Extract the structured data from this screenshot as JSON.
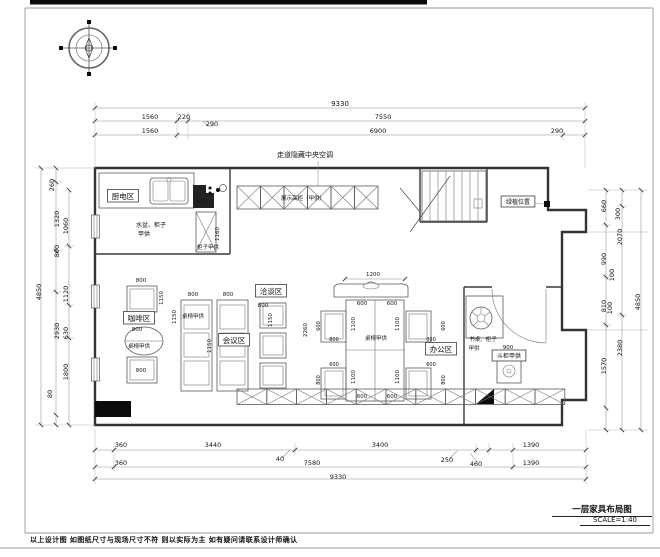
{
  "page": {
    "footer_note": "以上设计图 如图纸尺寸与现场尺寸不符 则以实际为主 如有疑问请联系设计师确认",
    "title_block": {
      "title": "一层家具布局图",
      "scale": "SCALE=1:40"
    }
  },
  "plan": {
    "annotations": [
      {
        "n": "dim-top-total",
        "t": "9330",
        "x": 340,
        "y": 106,
        "s": 7
      },
      {
        "n": "dim-top",
        "t": "1560",
        "x": 150,
        "y": 119
      },
      {
        "n": "dim-top",
        "t": "220",
        "x": 184,
        "y": 119
      },
      {
        "n": "dim-top",
        "t": "290",
        "x": 212,
        "y": 126
      },
      {
        "n": "dim-top",
        "t": "7550",
        "x": 383,
        "y": 119
      },
      {
        "n": "dim-top",
        "t": "1560",
        "x": 150,
        "y": 133
      },
      {
        "n": "dim-top",
        "t": "6900",
        "x": 378,
        "y": 133
      },
      {
        "n": "dim-top",
        "t": "290",
        "x": 557,
        "y": 133
      },
      {
        "n": "label-central-ac",
        "t": "走道隐藏中央空调",
        "x": 305,
        "y": 157,
        "s": 7
      },
      {
        "n": "dim-bottom",
        "t": "360",
        "x": 121,
        "y": 447
      },
      {
        "n": "dim-bottom",
        "t": "3440",
        "x": 213,
        "y": 447
      },
      {
        "n": "dim-bottom",
        "t": "40",
        "x": 280,
        "y": 461
      },
      {
        "n": "dim-bottom",
        "t": "3400",
        "x": 380,
        "y": 447
      },
      {
        "n": "dim-bottom",
        "t": "250",
        "x": 447,
        "y": 462
      },
      {
        "n": "dim-bottom",
        "t": "460",
        "x": 476,
        "y": 466
      },
      {
        "n": "dim-bottom",
        "t": "1390",
        "x": 531,
        "y": 447
      },
      {
        "n": "dim-bottom",
        "t": "360",
        "x": 121,
        "y": 465
      },
      {
        "n": "dim-bottom",
        "t": "7580",
        "x": 312,
        "y": 465
      },
      {
        "n": "dim-bottom",
        "t": "1390",
        "x": 531,
        "y": 465
      },
      {
        "n": "dim-bottom-total",
        "t": "9330",
        "x": 338,
        "y": 479
      },
      {
        "n": "dim-left-total",
        "t": "4850",
        "x": 41,
        "y": 292,
        "r": -90
      },
      {
        "n": "dim-left",
        "t": "260",
        "x": 54,
        "y": 185,
        "r": -90
      },
      {
        "n": "dim-left",
        "t": "1320",
        "x": 59,
        "y": 219,
        "r": -90
      },
      {
        "n": "dim-left",
        "t": "800",
        "x": 59,
        "y": 251,
        "r": -90
      },
      {
        "n": "dim-left",
        "t": "2930",
        "x": 59,
        "y": 331,
        "r": -90
      },
      {
        "n": "dim-left",
        "t": "80",
        "x": 52,
        "y": 394,
        "r": -90
      },
      {
        "n": "dim-left",
        "t": "1060",
        "x": 68,
        "y": 226,
        "r": -90
      },
      {
        "n": "dim-left",
        "t": "1120",
        "x": 68,
        "y": 294,
        "r": -90
      },
      {
        "n": "dim-left",
        "t": "630",
        "x": 68,
        "y": 333,
        "r": -90
      },
      {
        "n": "dim-left",
        "t": "1800",
        "x": 68,
        "y": 372,
        "r": -90
      },
      {
        "n": "dim-right-total",
        "t": "4850",
        "x": 640,
        "y": 302,
        "r": -90
      },
      {
        "n": "dim-right",
        "t": "300",
        "x": 620,
        "y": 214,
        "r": -90
      },
      {
        "n": "dim-right",
        "t": "2070",
        "x": 622,
        "y": 237,
        "r": -90
      },
      {
        "n": "dim-right",
        "t": "2380",
        "x": 622,
        "y": 348,
        "r": -90
      },
      {
        "n": "dim-right",
        "t": "660",
        "x": 606,
        "y": 206,
        "r": -90
      },
      {
        "n": "dim-right",
        "t": "990",
        "x": 606,
        "y": 259,
        "r": -90
      },
      {
        "n": "dim-right",
        "t": "100",
        "x": 614,
        "y": 275,
        "r": -90
      },
      {
        "n": "dim-right",
        "t": "810",
        "x": 606,
        "y": 306,
        "r": -90
      },
      {
        "n": "dim-right",
        "t": "100",
        "x": 612,
        "y": 308,
        "r": -90
      },
      {
        "n": "dim-right",
        "t": "1570",
        "x": 606,
        "y": 366,
        "r": -90
      },
      {
        "n": "zone-label-kitchen",
        "t": "厨电区",
        "x": 123,
        "y": 199,
        "b": 1,
        "s": 7.5
      },
      {
        "n": "zone-label-coffee",
        "t": "咖啡区",
        "x": 139,
        "y": 321,
        "b": 1,
        "s": 7.5
      },
      {
        "n": "zone-label-negotiation",
        "t": "洽谈区",
        "x": 271,
        "y": 294,
        "b": 1,
        "s": 7.5
      },
      {
        "n": "zone-label-meeting",
        "t": "会议区",
        "x": 234,
        "y": 343,
        "b": 1,
        "s": 7.5
      },
      {
        "n": "zone-label-office",
        "t": "办公区",
        "x": 441,
        "y": 352,
        "b": 1,
        "s": 7.5
      },
      {
        "n": "zone-label-chest",
        "t": "斗柜甲供",
        "x": 509,
        "y": 358,
        "b": 1,
        "s": 6
      },
      {
        "n": "zone-label-plant",
        "t": "绿植位置",
        "x": 518,
        "y": 204,
        "b": 1,
        "s": 6
      },
      {
        "n": "note-sink",
        "t": "水盆、柜子",
        "x": 151,
        "y": 227,
        "s": 6
      },
      {
        "n": "note-sink2",
        "t": "甲供",
        "x": 144,
        "y": 236,
        "s": 6
      },
      {
        "n": "dim-kitchen",
        "t": "600",
        "x": 202,
        "y": 203,
        "s": 5.5
      },
      {
        "n": "dim-kitchen",
        "t": "1160",
        "x": 219,
        "y": 234,
        "r": -90,
        "s": 5.5
      },
      {
        "n": "note-cabinet",
        "t": "柜子甲供",
        "x": 208,
        "y": 249,
        "s": 5.5
      },
      {
        "n": "note-display-cabinet",
        "t": "展示高柜（甲供）",
        "x": 303,
        "y": 200,
        "s": 5.5
      },
      {
        "n": "note-coffee-furniture",
        "t": "桌椅甲供",
        "x": 139,
        "y": 348,
        "s": 5.5
      },
      {
        "n": "note-meeting-furniture",
        "t": "桌椅甲供",
        "x": 193,
        "y": 318,
        "s": 5.5
      },
      {
        "n": "note-dining-furniture",
        "t": "桌椅甲供",
        "x": 376,
        "y": 340,
        "s": 5.5
      },
      {
        "n": "note-desk",
        "t": "书桌、柜子",
        "x": 483,
        "y": 341,
        "s": 5.5
      },
      {
        "n": "note-desk2",
        "t": "甲供",
        "x": 474,
        "y": 350,
        "s": 5.5
      },
      {
        "n": "dim-chest",
        "t": "900",
        "x": 508,
        "y": 349,
        "s": 5.5
      },
      {
        "n": "dim-coffee",
        "t": "800",
        "x": 141,
        "y": 282,
        "s": 5.5
      },
      {
        "n": "dim-coffee",
        "t": "1150",
        "x": 163,
        "y": 298,
        "r": -90,
        "s": 5.5
      },
      {
        "n": "dim-coffee",
        "t": "800",
        "x": 137,
        "y": 331,
        "s": 5.5
      },
      {
        "n": "dim-coffee",
        "t": "800",
        "x": 141,
        "y": 372,
        "s": 5.5
      },
      {
        "n": "dim-meeting",
        "t": "800",
        "x": 193,
        "y": 296,
        "s": 5.5
      },
      {
        "n": "dim-meeting",
        "t": "800",
        "x": 228,
        "y": 296,
        "s": 5.5
      },
      {
        "n": "dim-meeting",
        "t": "1150",
        "x": 176,
        "y": 317,
        "r": -90,
        "s": 5.5
      },
      {
        "n": "dim-meeting",
        "t": "1150",
        "x": 211,
        "y": 346,
        "r": -90,
        "s": 5.5
      },
      {
        "n": "dim-negotiation",
        "t": "800",
        "x": 263,
        "y": 307,
        "s": 5.5
      },
      {
        "n": "dim-negotiation",
        "t": "1150",
        "x": 272,
        "y": 320,
        "r": -90,
        "s": 5.5
      },
      {
        "n": "dim-dining",
        "t": "1200",
        "x": 373,
        "y": 276,
        "s": 5.5
      },
      {
        "n": "dim-dining",
        "t": "600",
        "x": 362,
        "y": 305,
        "s": 5.5
      },
      {
        "n": "dim-dining",
        "t": "600",
        "x": 392,
        "y": 305,
        "s": 5.5
      },
      {
        "n": "dim-dining",
        "t": "600",
        "x": 362,
        "y": 398,
        "s": 5.5
      },
      {
        "n": "dim-dining",
        "t": "600",
        "x": 392,
        "y": 398,
        "s": 5.5
      },
      {
        "n": "dim-dining",
        "t": "1100",
        "x": 355,
        "y": 324,
        "r": -90,
        "s": 5.5
      },
      {
        "n": "dim-dining",
        "t": "1100",
        "x": 399,
        "y": 324,
        "r": -90,
        "s": 5.5
      },
      {
        "n": "dim-dining",
        "t": "1100",
        "x": 355,
        "y": 377,
        "r": -90,
        "s": 5.5
      },
      {
        "n": "dim-dining",
        "t": "1100",
        "x": 399,
        "y": 377,
        "r": -90,
        "s": 5.5
      },
      {
        "n": "dim-dining",
        "t": "2260",
        "x": 307,
        "y": 330,
        "r": -90,
        "s": 5.5
      },
      {
        "n": "dim-chair",
        "t": "600",
        "x": 320,
        "y": 326,
        "r": -90,
        "s": 5
      },
      {
        "n": "dim-chair",
        "t": "800",
        "x": 334,
        "y": 341,
        "s": 5
      },
      {
        "n": "dim-chair",
        "t": "600",
        "x": 334,
        "y": 366,
        "s": 5
      },
      {
        "n": "dim-chair",
        "t": "800",
        "x": 320,
        "y": 380,
        "r": -90,
        "s": 5
      },
      {
        "n": "dim-chair",
        "t": "600",
        "x": 445,
        "y": 326,
        "r": -90,
        "s": 5
      },
      {
        "n": "dim-chair",
        "t": "800",
        "x": 431,
        "y": 341,
        "s": 5
      },
      {
        "n": "dim-chair",
        "t": "600",
        "x": 431,
        "y": 366,
        "s": 5
      },
      {
        "n": "dim-chair",
        "t": "800",
        "x": 445,
        "y": 380,
        "r": -90,
        "s": 5
      }
    ]
  }
}
